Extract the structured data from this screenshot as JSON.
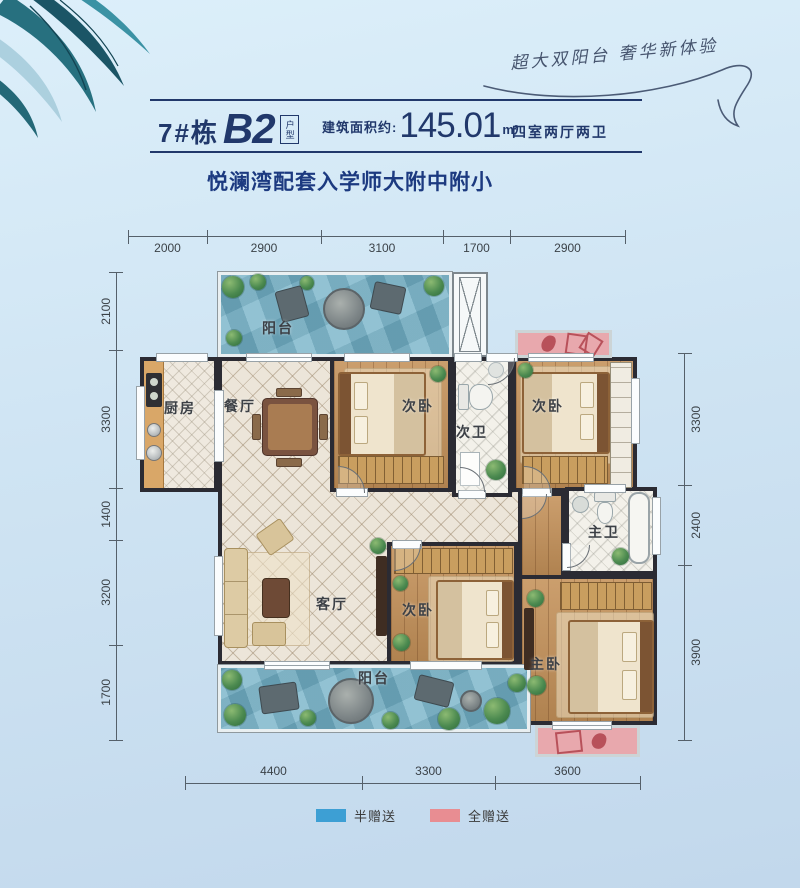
{
  "tagline": {
    "text": "超大双阳台 奢华新体验"
  },
  "header": {
    "building": "7#栋",
    "unit": "B2",
    "unit_tag": "户型",
    "area_label": "建筑面积约:",
    "area_value": "145.01",
    "area_unit": "m²",
    "rooms_summary": "四室两厅两卫"
  },
  "subtitle": "悦澜湾配套入学师大附中附小",
  "dimensions": {
    "top": [
      "2000",
      "2900",
      "3100",
      "1700",
      "2900"
    ],
    "left": [
      "2100",
      "3300",
      "1400",
      "3200",
      "1700"
    ],
    "right": [
      "3300",
      "2400",
      "3900"
    ],
    "bottom": [
      "4400",
      "3300",
      "3600"
    ]
  },
  "rooms": {
    "balcony_top": "阳台",
    "kitchen": "厨房",
    "dining": "餐厅",
    "bedroom_a": "次卧",
    "bath_second": "次卫",
    "bedroom_b": "次卧",
    "living": "客厅",
    "bedroom_c": "次卧",
    "bath_master": "主卫",
    "bedroom_master": "主卧",
    "balcony_bottom": "阳台"
  },
  "legend": {
    "half_gift": {
      "label": "半赠送",
      "color": "#3d9fd4"
    },
    "full_gift": {
      "label": "全赠送",
      "color": "#e88d92"
    }
  },
  "colors": {
    "accent_navy": "#21386b",
    "balcony_water": "#7db6ca",
    "gift_pink": "#e8a8ad",
    "wood_floor": "#c49159",
    "wall": "#2b2b33"
  }
}
